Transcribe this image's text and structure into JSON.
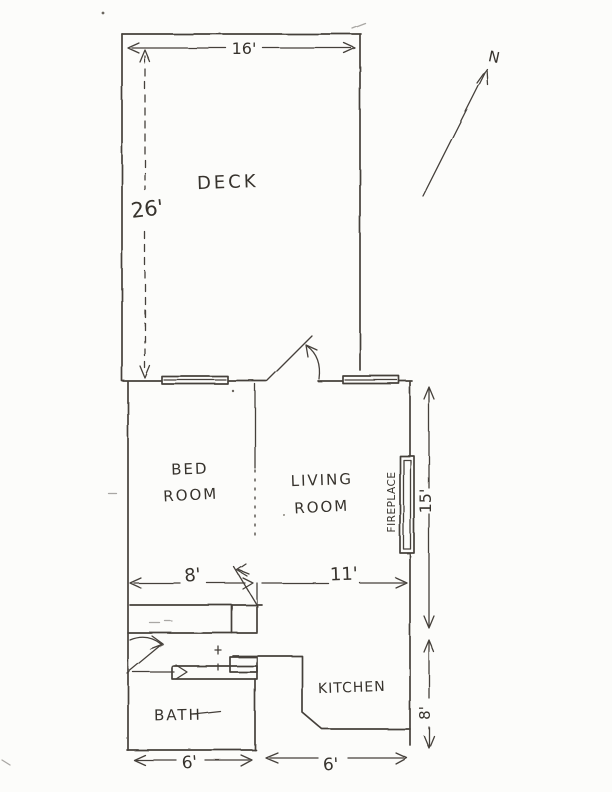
{
  "page": {
    "paper_color": "#fcfcfa",
    "ink_color": "#45403a"
  },
  "compass": {
    "label": "N"
  },
  "rooms": {
    "deck": "DECK",
    "bed_line1": "BED",
    "bed_line2": "ROOM",
    "living_line1": "LIVING",
    "living_line2": "ROOM",
    "kitchen": "KITCHEN",
    "bath": "BATH",
    "fireplace": "FIREPLACE"
  },
  "dimensions": {
    "deck_width": "16'",
    "deck_depth": "26'",
    "main_depth": "15'",
    "bedroom_width": "8'",
    "living_width": "11'",
    "bath_width": "6'",
    "kitchen_width": "6'",
    "kitchen_depth": "8'"
  }
}
